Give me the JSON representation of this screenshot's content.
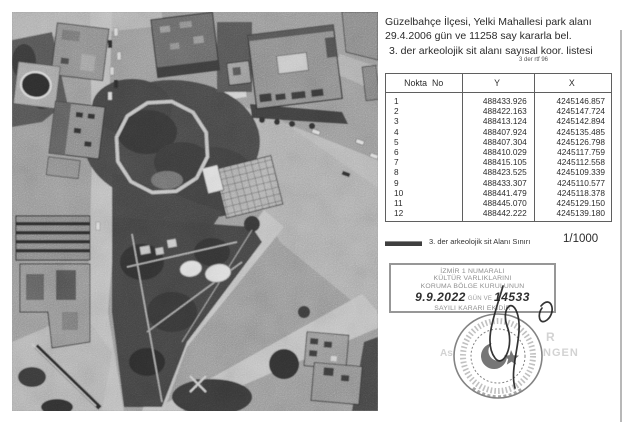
{
  "header": {
    "line1": "Güzelbahçe İlçesi, Yelki Mahallesi park alanı",
    "line2": "29.4.2006 gün ve 11258 say kararla bel.",
    "line3": "3. der arkeolojik sit alanı sayısal koor. listesi",
    "note": "3 der rtf 96"
  },
  "table": {
    "headers": [
      "Nokta  No",
      "Y",
      "X"
    ],
    "rows": [
      [
        "1",
        "488433.926",
        "4245146.857"
      ],
      [
        "2",
        "488422.163",
        "4245147.724"
      ],
      [
        "3",
        "488413.124",
        "4245142.894"
      ],
      [
        "4",
        "488407.924",
        "4245135.485"
      ],
      [
        "5",
        "488407.304",
        "4245126.798"
      ],
      [
        "6",
        "488410.029",
        "4245117.759"
      ],
      [
        "7",
        "488415.105",
        "4245112.558"
      ],
      [
        "8",
        "488423.525",
        "4245109.339"
      ],
      [
        "9",
        "488433.307",
        "4245110.577"
      ],
      [
        "10",
        "488441.479",
        "4245118.378"
      ],
      [
        "11",
        "488445.070",
        "4245129.150"
      ],
      [
        "12",
        "488442.222",
        "4245139.180"
      ]
    ]
  },
  "legend": {
    "label": "3. der arkeolojik sit Alanı Sınırı",
    "scale": "1/1000"
  },
  "stamp": {
    "line1": "İZMİR 1 NUMARALI",
    "line2": "KÜLTÜR VARLIKLARINI",
    "line3": "KORUMA BÖLGE KURULUNUN",
    "hand_date": "9.9.2022",
    "printed_mid": "GÜN VE",
    "hand_number": "14533",
    "line5": "SAYILI KARARI EKİDİR"
  },
  "faint_text": {
    "fragment_top": "R",
    "fragment_left": "As",
    "fragment_right": "NGEN"
  },
  "colors": {
    "boundary_line": "#c4c4c4",
    "stamp_ink": "#8f8f8f",
    "handwriting_ink": "#2f2f2f"
  }
}
